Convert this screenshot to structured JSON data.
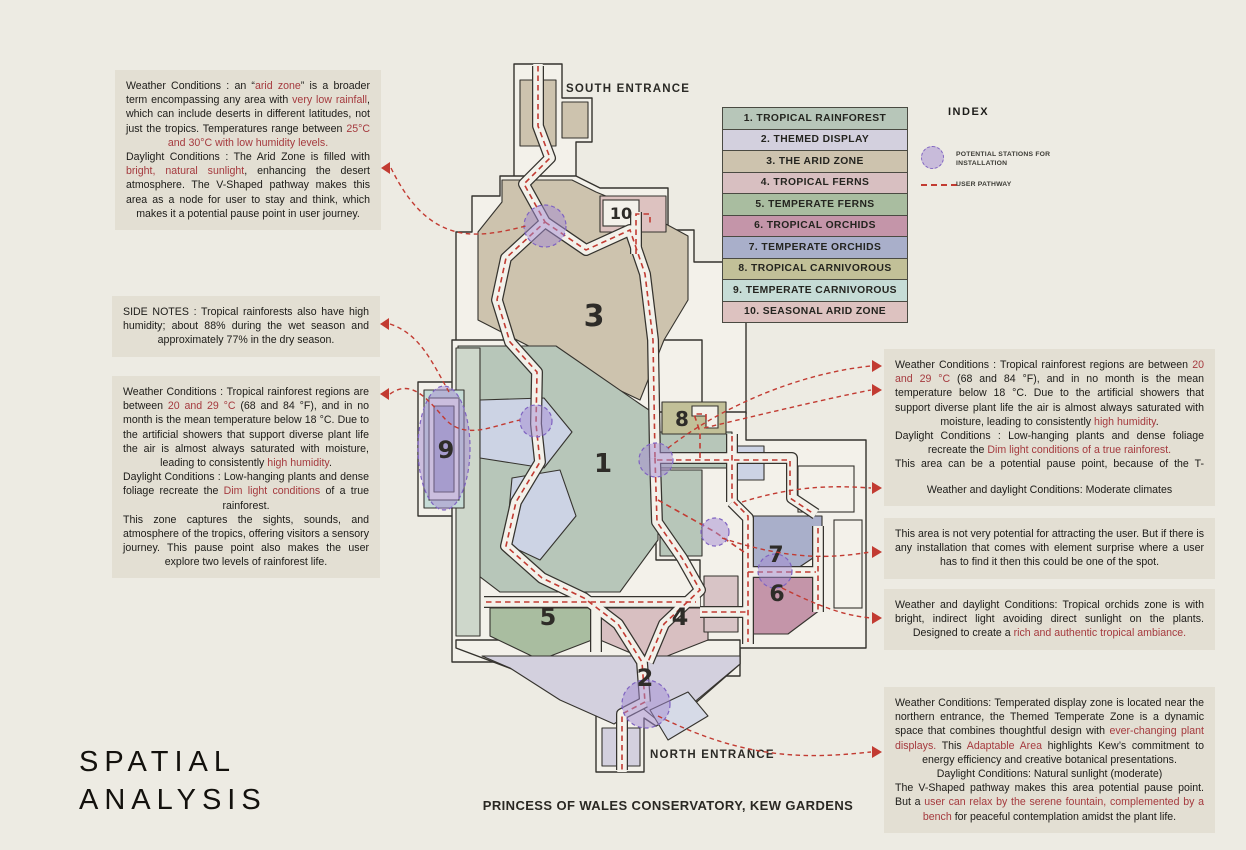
{
  "title": {
    "line1": "SPATIAL",
    "line2": "ANALYSIS"
  },
  "caption": "PRINCESS OF WALES CONSERVATORY, KEW GARDENS",
  "colors": {
    "background": "#edebe3",
    "note_background": "#e3dfd3",
    "highlight_red": "#a53a3e",
    "pathway_red": "#c23b32",
    "station_purple": "#7f63c1",
    "wall": "#35332e",
    "floor": "#f3f1ea"
  },
  "index": {
    "title": "INDEX",
    "items": [
      {
        "label": "1. TROPICAL RAINFOREST",
        "color": "#b7c6b9"
      },
      {
        "label": "2. THEMED DISPLAY",
        "color": "#d3d0de"
      },
      {
        "label": "3. THE ARID ZONE",
        "color": "#cdc3ae"
      },
      {
        "label": "4. TROPICAL FERNS",
        "color": "#d8bfc1"
      },
      {
        "label": "5. TEMPERATE FERNS",
        "color": "#a9bda0"
      },
      {
        "label": "6. TROPICAL ORCHIDS",
        "color": "#c495a9"
      },
      {
        "label": "7. TEMPERATE ORCHIDS",
        "color": "#a9afca"
      },
      {
        "label": "8. TROPICAL CARNIVOROUS",
        "color": "#c2c098"
      },
      {
        "label": "9. TEMPERATE CARNIVOROUS",
        "color": "#c6dcd6"
      },
      {
        "label": "10. SEASONAL ARID ZONE",
        "color": "#ddc2c0"
      }
    ],
    "stations_label": "POTENTIAL STATIONS FOR INSTALLATION",
    "pathway_label": "USER PATHWAY"
  },
  "map": {
    "south_entrance": "SOUTH ENTRANCE",
    "north_entrance": "NORTH ENTRANCE",
    "zone_numbers": {
      "z1": "1",
      "z2": "2",
      "z3": "3",
      "z4": "4",
      "z5": "5",
      "z6": "6",
      "z7": "7",
      "z8": "8",
      "z9": "9",
      "z10": "10"
    }
  },
  "notes_left": [
    {
      "segments": [
        {
          "t": "Weather Conditions : an “"
        },
        {
          "t": "arid zone",
          "red": true
        },
        {
          "t": "” is a broader term encompassing any area with "
        },
        {
          "t": "very low rainfall",
          "red": true
        },
        {
          "t": ", which can include deserts in different latitudes, not just the tropics. Temperatures range between "
        },
        {
          "t": "25°C and 30°C with low humidity levels.",
          "red": true
        },
        {
          "t": "\nDaylight Conditions : The Arid Zone is filled with "
        },
        {
          "t": "bright, natural sunlight",
          "red": true
        },
        {
          "t": ", enhancing the desert atmosphere. The V-Shaped pathway makes this area as a node for user to stay and think, which makes it a potential pause point in user journey."
        }
      ]
    },
    {
      "segments": [
        {
          "t": "SIDE NOTES : Tropical rainforests also have high humidity; about 88% during the wet season and approximately 77% in the dry season."
        }
      ]
    },
    {
      "segments": [
        {
          "t": "Weather Conditions : Tropical rainforest regions are between "
        },
        {
          "t": "20 and 29 °C",
          "red": true
        },
        {
          "t": " (68 and 84 °F), and in no month is the mean temperature below 18 °C. Due to the artificial showers that support diverse plant life the air is almost always saturated with moisture, leading to consistently "
        },
        {
          "t": "high humidity",
          "red": true
        },
        {
          "t": ".\nDaylight Conditions : Low-hanging plants and dense foliage recreate the "
        },
        {
          "t": "Dim light conditions",
          "red": true
        },
        {
          "t": " of a true rainforest.\nThis zone captures the sights, sounds, and atmosphere of the tropics, offering visitors a sensory journey. This pause point also makes the user explore two levels of rainforest life."
        }
      ]
    }
  ],
  "notes_right": [
    {
      "segments": [
        {
          "t": "Weather Conditions : Tropical rainforest regions are between "
        },
        {
          "t": "20 and 29 °C",
          "red": true
        },
        {
          "t": " (68 and 84 °F), and in no month is the mean temperature below 18 °C. Due to the artificial showers that support diverse plant life the air is almost always saturated with moisture, leading to consistently "
        },
        {
          "t": "high humidity",
          "red": true
        },
        {
          "t": ".\nDaylight Conditions : Low-hanging plants and dense foliage recreate the "
        },
        {
          "t": "Dim light conditions of a true rainforest.",
          "red": true
        },
        {
          "t": "\nThis area can be a potential pause point, because of the T-Junction."
        }
      ]
    },
    {
      "segments": [
        {
          "t": "Weather and daylight Conditions: Moderate climates"
        }
      ]
    },
    {
      "segments": [
        {
          "t": "This area is not very potential for attracting the user. But if there is any installation that comes with element surprise where a user has to find it then this could be one of the spot."
        }
      ]
    },
    {
      "segments": [
        {
          "t": "Weather and daylight Conditions: Tropical orchids zone is with bright, indirect light avoiding direct sunlight on the plants. Designed to create a "
        },
        {
          "t": "rich and authentic tropical ambiance.",
          "red": true
        }
      ]
    },
    {
      "segments": [
        {
          "t": "Weather Conditions: Temperated display zone is located near the northern entrance, the Themed Temperate Zone is a dynamic space that combines thoughtful design with "
        },
        {
          "t": "ever-changing plant displays.",
          "red": true
        },
        {
          "t": " This "
        },
        {
          "t": "Adaptable Area",
          "red": true
        },
        {
          "t": " highlights Kew’s commitment to energy efficiency and creative botanical presentations.\nDaylight Conditions: Natural sunlight (moderate)\nThe V-Shaped pathway makes this area potential pause point. But a "
        },
        {
          "t": "user can relax by the serene fountain, complemented by a bench",
          "red": true
        },
        {
          "t": " for peaceful contemplation amidst the plant life."
        }
      ]
    }
  ]
}
